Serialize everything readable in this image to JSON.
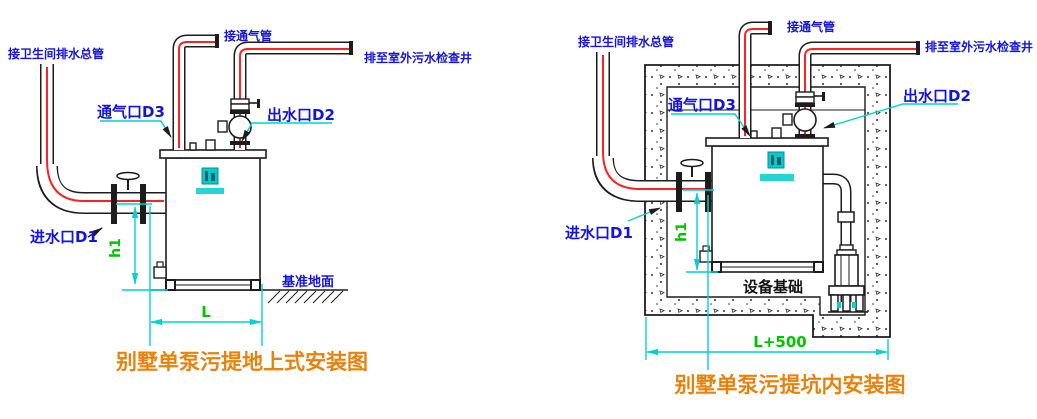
{
  "colors": {
    "label_blue": "#1414dc",
    "dim_cyan": "#00d2d2",
    "dim_green": "#00c400",
    "pipe_red": "#ff2222",
    "line_black": "#1c1c1c",
    "title_orange": "#e8820c",
    "logo_cyan": "#00cccc"
  },
  "left": {
    "title": "别墅单泵污提地上式安装图",
    "labels": {
      "drain_main": "接卫生间排水总管",
      "vent_connect": "接通气管",
      "discharge_well": "排至室外污水检查井",
      "vent_port": "通气口D3",
      "outlet_port": "出水口D2",
      "inlet_port": "进水口D1",
      "datum_ground": "基准地面"
    },
    "dims": {
      "height": "h1",
      "length": "L"
    }
  },
  "right": {
    "title": "别墅单泵污提坑内安装图",
    "labels": {
      "drain_main": "接卫生间排水总管",
      "vent_connect": "接通气管",
      "discharge_well": "排至室外污水检查井",
      "vent_port": "通气口D3",
      "outlet_port": "出水口D2",
      "inlet_port": "进水口D1",
      "foundation": "设备基础"
    },
    "dims": {
      "height": "h1",
      "length": "L+500"
    }
  }
}
